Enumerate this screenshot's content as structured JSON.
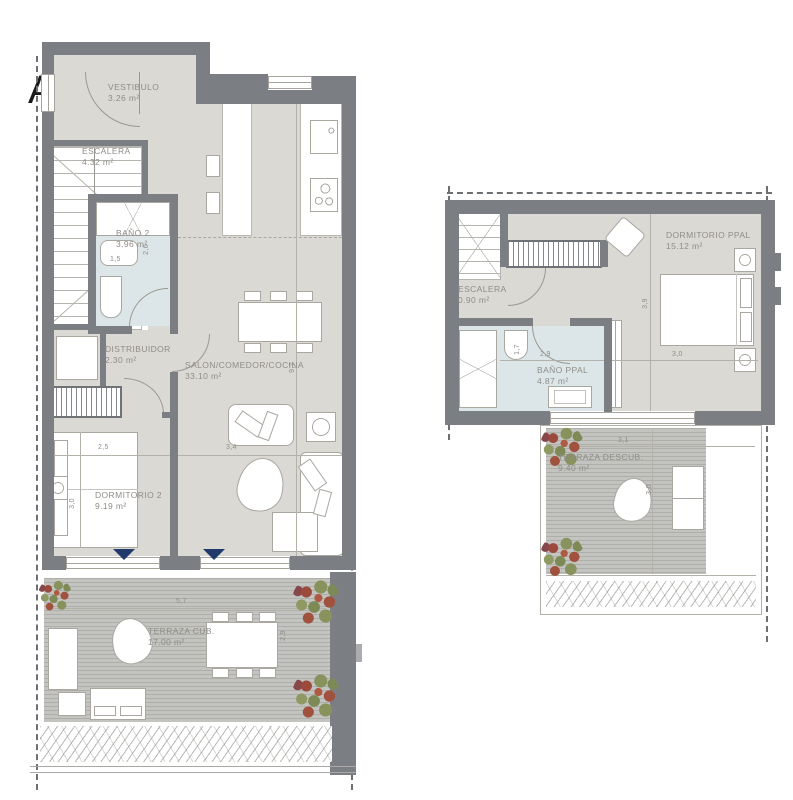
{
  "section_marker": {
    "label": "A"
  },
  "colors": {
    "wall": "#7b7f84",
    "floor": "#dbd9d3",
    "bathroom_floor": "#dce6e9",
    "deck": "#c3c3c0",
    "accent_navy": "#1f3a6b",
    "label_text": "#8f8d86"
  },
  "left_plan": {
    "vestibulo": {
      "name": "VESTIBULO",
      "area": "3.26 m²"
    },
    "escalera": {
      "name": "ESCALERA",
      "area": "4.32 m²"
    },
    "bano2": {
      "name": "BAÑO 2",
      "area": "3.96 m²"
    },
    "distribuidor": {
      "name": "DISTRIBUIDOR",
      "area": "2.30 m²"
    },
    "salon": {
      "name": "SALON/COMEDOR/COCINA",
      "area": "33.10 m²"
    },
    "dormitorio2": {
      "name": "DORMITORIO 2",
      "area": "9.19 m²"
    },
    "terraza": {
      "name": "TERRAZA CUB.",
      "area": "17.00 m²"
    },
    "dims": {
      "bano_w": "1,5",
      "bano_h": "2,6",
      "dorm_w": "2,5",
      "dorm_h": "3,0",
      "salon_w": "3,4",
      "salon_h": "9,7",
      "terraza_w": "5,7",
      "terraza_h": "2,9"
    }
  },
  "right_plan": {
    "escalera": {
      "name": "ESCALERA",
      "area": "0.90 m²"
    },
    "dormitorio": {
      "name": "DORMITORIO PPAL",
      "area": "15.12 m²"
    },
    "bano": {
      "name": "BAÑO PPAL",
      "area": "4.87 m²"
    },
    "terraza": {
      "name": "TERRAZA DESCUB.",
      "area": "9.40 m²"
    },
    "dims": {
      "bano_h": "1,7",
      "bano_w": "2,9",
      "dorm_h": "3,9",
      "dorm_w": "3,0",
      "terraza_w": "3,1",
      "terraza_h": "3,0"
    }
  }
}
